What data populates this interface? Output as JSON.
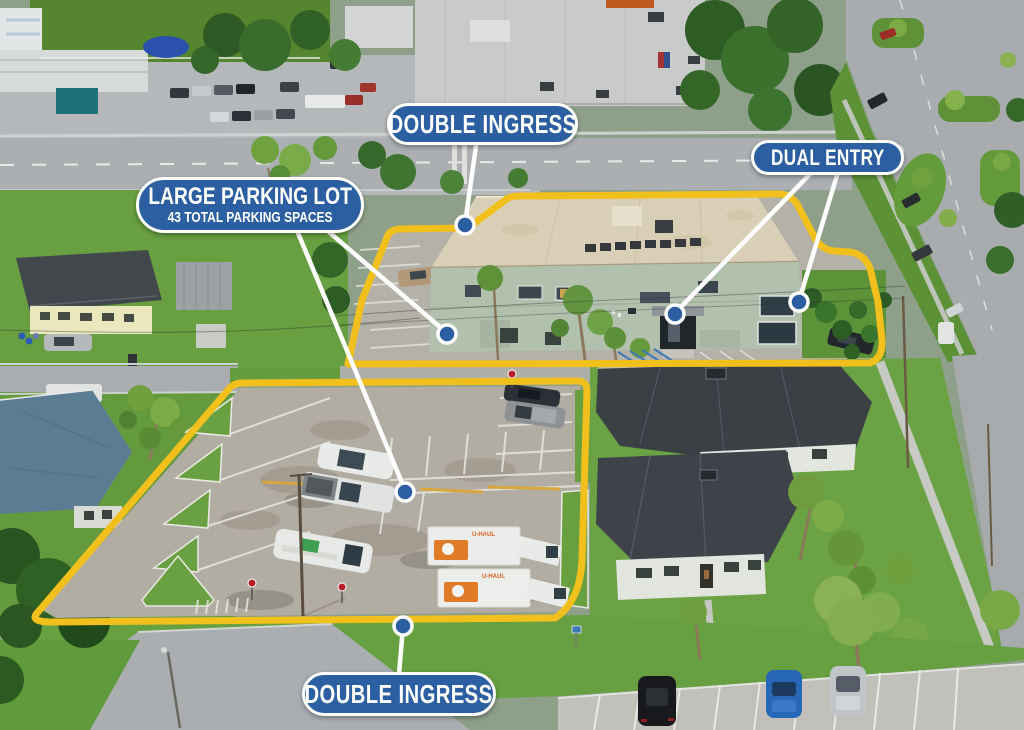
{
  "annotations": {
    "double_ingress_top": {
      "text": "DOUBLE INGRESS"
    },
    "large_parking_lot": {
      "title": "LARGE PARKING LOT",
      "subtitle": "43 TOTAL PARKING SPACES"
    },
    "dual_entry": {
      "text": "DUAL ENTRY"
    },
    "double_ingress_bottom": {
      "text": "DOUBLE INGRESS"
    }
  },
  "vehicles": {
    "uhaul_brand": "U-HAUL"
  },
  "colors": {
    "annotation_blue": "#2b5fa1",
    "boundary_yellow": "#f2c01d",
    "leader_line_white": "#ffffff"
  }
}
